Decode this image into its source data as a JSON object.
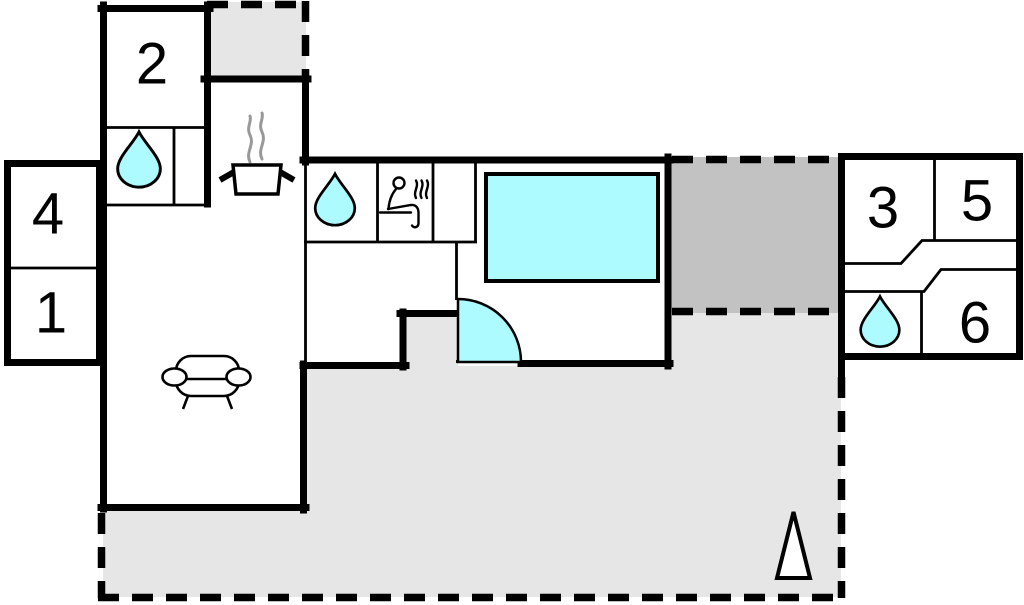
{
  "plan": {
    "type": "floor-plan"
  },
  "room_labels": {
    "r1": "1",
    "r2": "2",
    "r3": "3",
    "r4": "4",
    "r5": "5",
    "r6": "6"
  },
  "colors": {
    "background": "#ffffff",
    "wall": "#000000",
    "water": "#adfaff",
    "terrace": "#e6e6e6",
    "covered_terrace": "#c2c2c2",
    "steam": "#999999",
    "label": "#000000"
  },
  "icons": {
    "water_drop": "teardrop",
    "stove": "cooking-pot-with-steam",
    "sauna": "person-sitting-with-steam",
    "sofa": "sofa-outline",
    "door": "quarter-circle-door-swing",
    "north_arrow": "upward-triangle",
    "pool": "rectangular-pool"
  }
}
